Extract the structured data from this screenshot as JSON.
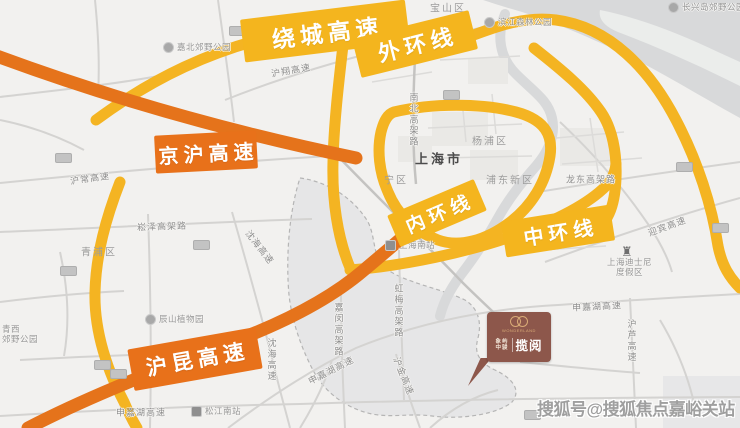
{
  "map": {
    "badges": [
      {
        "id": "raocheng-expressway",
        "label": "绕城高速"
      },
      {
        "id": "outer-ring",
        "label": "外环线"
      },
      {
        "id": "jinghu-expressway",
        "label": "京沪高速"
      },
      {
        "id": "inner-ring",
        "label": "内环线"
      },
      {
        "id": "middle-ring",
        "label": "中环线"
      },
      {
        "id": "hukun-expressway",
        "label": "沪昆高速"
      }
    ],
    "city_label": "上海市",
    "districts": [
      {
        "label": "宝山区"
      },
      {
        "label": "青浦区"
      },
      {
        "label": "杨浦区"
      },
      {
        "label": "浦东新区"
      },
      {
        "label": "宁区"
      }
    ],
    "road_labels": [
      {
        "label": "沪翔高速"
      },
      {
        "label": "沪常高速"
      },
      {
        "label": "崧泽高架路"
      },
      {
        "label": "南北高架路"
      },
      {
        "label": "沈海高速"
      },
      {
        "label": "沈海高速"
      },
      {
        "label": "嘉闵高架路"
      },
      {
        "label": "申嘉湖高速"
      },
      {
        "label": "申嘉湖高速"
      },
      {
        "label": "申嘉湖高速"
      },
      {
        "label": "虹梅高架路"
      },
      {
        "label": "沪金高速"
      },
      {
        "label": "沪芦高速"
      },
      {
        "label": "迎宾高速"
      },
      {
        "label": "龙东高架路"
      }
    ],
    "poi_labels": [
      {
        "label": "嘉北郊野公园"
      },
      {
        "label": "滨江森林公园"
      },
      {
        "label": "长兴岛郊野公园"
      },
      {
        "label": "辰山植物园"
      },
      {
        "label": "上海迪士尼",
        "label2": "度假区"
      },
      {
        "label": "青西",
        "label2": "郊野公园"
      }
    ],
    "stations": [
      {
        "label": "上海南站"
      },
      {
        "label": "松江南站"
      }
    ],
    "project_marker": {
      "brand_top": "象屿",
      "brand_bottom": "中骏",
      "project_name": "揽阅",
      "tagline": "WONDERLAND"
    },
    "watermark": "搜狐号@搜狐焦点嘉峪关站",
    "colors": {
      "ring_yellow": "#F4B51E",
      "expressway_orange": "#E5731B",
      "marker_brown": "#8D574B",
      "water_gray": "#D8D9DA"
    }
  }
}
